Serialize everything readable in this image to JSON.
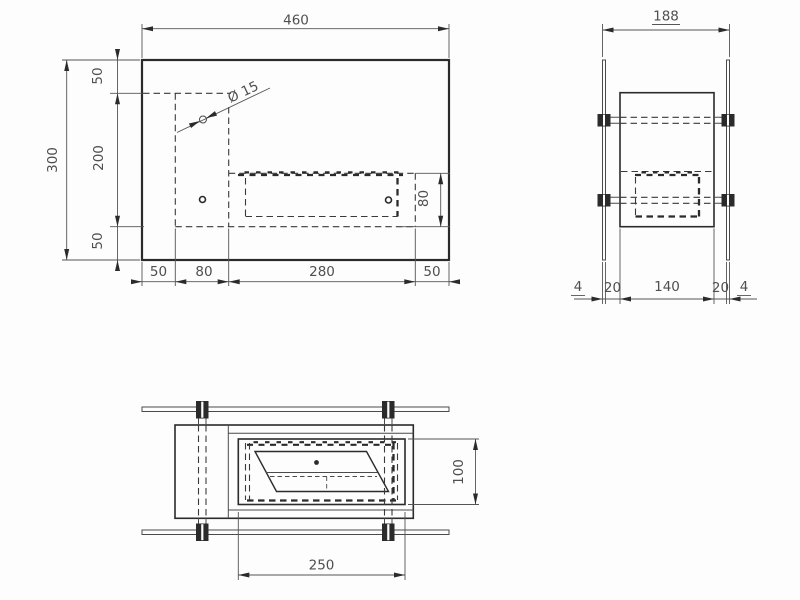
{
  "drawing": {
    "type": "technical-orthographic-drawing",
    "colors": {
      "line_ink": "#2b2b2b",
      "dim_ink": "#4f4f4f",
      "background": "#fdfdfd"
    },
    "front_view": {
      "overall_width": "460",
      "overall_height": "300",
      "chain_left": [
        "50",
        "200",
        "50"
      ],
      "chain_bottom": [
        "50",
        "80",
        "280",
        "50"
      ],
      "opening_height": "80",
      "hole_diameter": "Ø 15"
    },
    "side_view": {
      "overall_width": "188",
      "chain_bottom": [
        "4",
        "20",
        "140",
        "20",
        "4"
      ]
    },
    "bottom_view": {
      "burner_length": "250",
      "burner_depth": "100"
    }
  }
}
